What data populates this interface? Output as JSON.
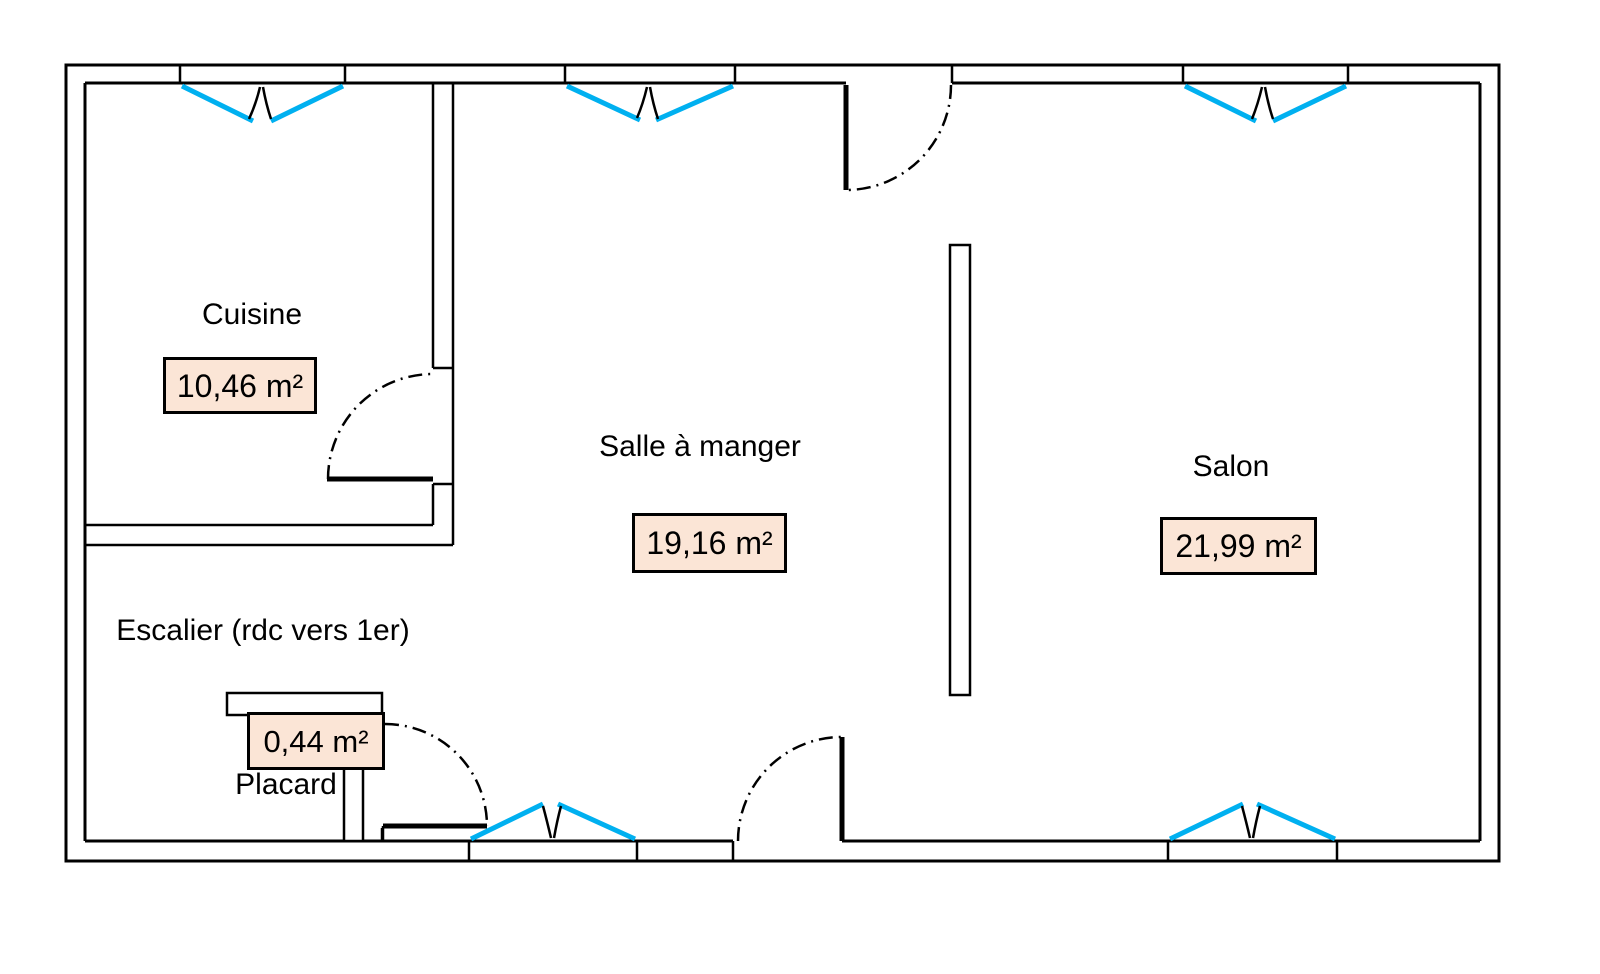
{
  "colors": {
    "wall": "#000000",
    "window": "#00B0F0",
    "area_box_fill": "#FBE5D6",
    "area_box_border": "#000000",
    "background": "#FFFFFF"
  },
  "rooms": {
    "cuisine": {
      "name": "Cuisine",
      "area": "10,46 m²"
    },
    "salle_a_manger": {
      "name": "Salle à manger",
      "area": "19,16 m²"
    },
    "salon": {
      "name": "Salon",
      "area": "21,99 m²"
    },
    "escalier": {
      "name": "Escalier (rdc vers 1er)"
    },
    "placard": {
      "name": "Placard",
      "area": "0,44 m²"
    }
  }
}
